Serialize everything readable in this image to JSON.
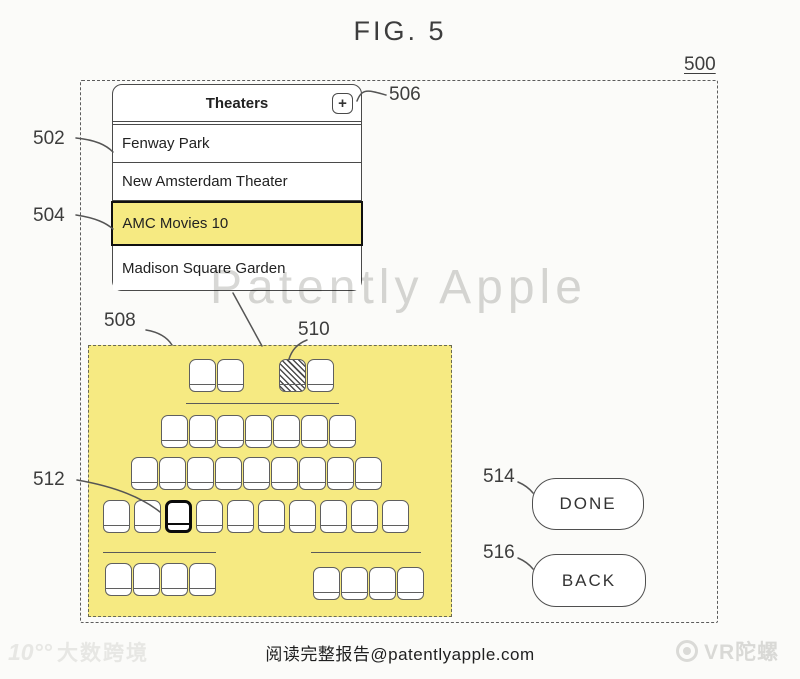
{
  "figure": {
    "title": "FIG. 5"
  },
  "refs": {
    "frame": "500",
    "theater_list": "502",
    "selected_theater": "504",
    "add_button": "506",
    "seat_map": "508",
    "unavailable_seat": "510",
    "selected_seat": "512",
    "done_button": "514",
    "back_button": "516"
  },
  "theater_list": {
    "title": "Theaters",
    "add_icon": "+",
    "items": [
      {
        "label": "Fenway Park",
        "selected": false
      },
      {
        "label": "New Amsterdam Theater",
        "selected": false
      },
      {
        "label": "AMC Movies 10",
        "selected": true
      },
      {
        "label": "Madison Square Garden",
        "selected": false
      }
    ]
  },
  "seat_map": {
    "back_row_pairs": [
      {
        "count": 2
      },
      {
        "count": 2,
        "hatched_index": 0
      }
    ],
    "main_rows": [
      {
        "count": 7
      },
      {
        "count": 9
      },
      {
        "count": 10,
        "selected_index": 2
      }
    ],
    "front_groups": [
      {
        "count": 4
      },
      {
        "count": 4
      }
    ]
  },
  "buttons": {
    "done": "DONE",
    "back": "BACK"
  },
  "watermarks": {
    "center": "Patently Apple",
    "bottom_left_icon": "10°°",
    "bottom_left": "大数跨境",
    "bottom_right": "VR陀螺"
  },
  "footer": {
    "text": "阅读完整报告@patentlyapple.com"
  },
  "colors": {
    "highlight_yellow": "#f6ea82",
    "watermark_gray": "#d8d8d6",
    "line_ink": "#555555"
  }
}
